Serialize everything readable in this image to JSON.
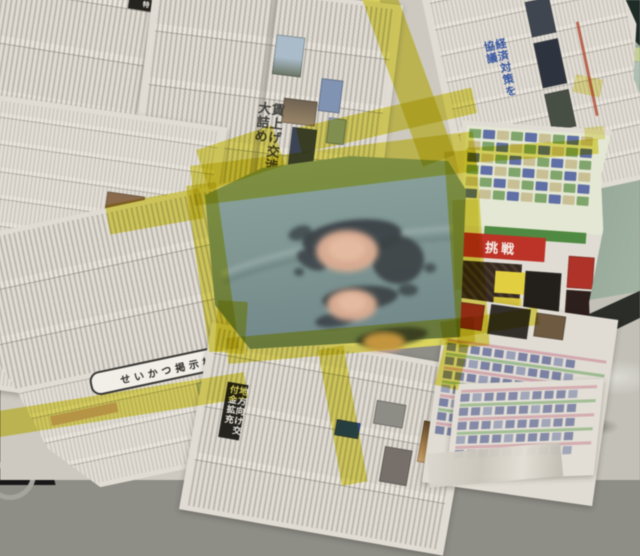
{
  "scene_title": "Automotive paint repair: car panel masked off with Japanese newspaper sheets and yellow masking tape; sanded body-filler spots on exposed teal panel",
  "colors": {
    "paper": "#e0dcd3",
    "paper_shade": "#cdc9bf",
    "ink": "#3f3e3a",
    "tape": "#e8df52",
    "panel_teal": "#7e9693",
    "panel_teal_light": "#8ca49f",
    "panel_teal_dark": "#71888a",
    "filler_peach": "#d9ab90",
    "filler_peach_light": "#e6bb9e",
    "sanded_dark": "#3a4144",
    "car_sage": "#92a694",
    "car_pale": "#dbe5df",
    "rocker_dark": "#2b2d28",
    "floor": "#c3c1b7",
    "shadow_dark": "#181818",
    "grid_cell": "#7b81a4",
    "grid_row_pink": "#d4a8ae",
    "grid_row_green": "#9cbb8e",
    "listing_green": "#7fa66a",
    "listing_blue": "#5f6fa8",
    "sports_red": "#c23326",
    "sports_green": "#4e8a3e",
    "sports_yellow": "#e3cf3a",
    "headline_blue": "#3556a2"
  },
  "newspaper": {
    "headline_seikatsu": "せいかつ掲示板",
    "headline_chihou": "地方向け交付金拡充",
    "headline_ai": "愛と平和",
    "headline_top_center": "賃上げ交渉大詰め",
    "headline_top_right": "経済対策を協議",
    "headline_sports": "挑戦",
    "tag_black_box_1": "特集",
    "tag_black_box_2": "解説"
  }
}
